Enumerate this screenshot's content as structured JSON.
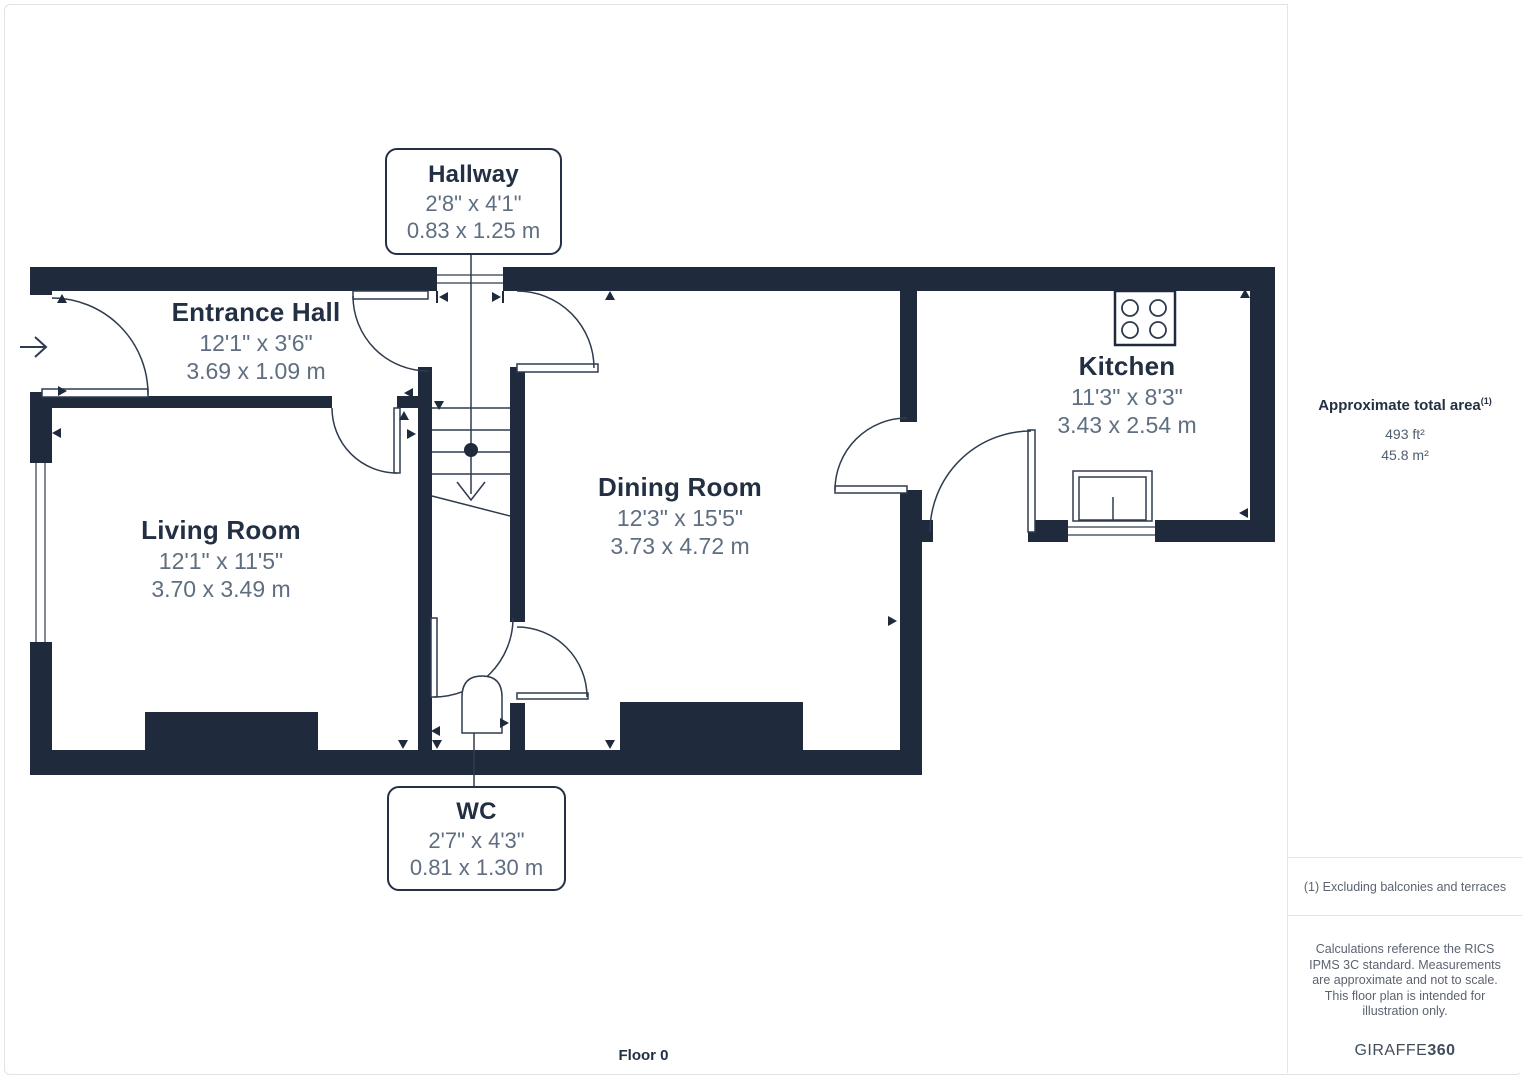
{
  "floor_plan": {
    "floor_label": "Floor 0",
    "rooms": [
      {
        "name": "Hallway",
        "imperial": "2'8\" x 4'1\"",
        "metric": "0.83 x 1.25 m"
      },
      {
        "name": "Entrance Hall",
        "imperial": "12'1\" x 3'6\"",
        "metric": "3.69 x 1.09 m"
      },
      {
        "name": "Living Room",
        "imperial": "12'1\" x 11'5\"",
        "metric": "3.70 x 3.49 m"
      },
      {
        "name": "Dining Room",
        "imperial": "12'3\" x 15'5\"",
        "metric": "3.73 x 4.72 m"
      },
      {
        "name": "Kitchen",
        "imperial": "11'3\" x 8'3\"",
        "metric": "3.43 x 2.54 m"
      },
      {
        "name": "WC",
        "imperial": "2'7\" x 4'3\"",
        "metric": "0.81 x 1.30 m"
      }
    ]
  },
  "sidebar": {
    "total_area_title": "Approximate total area",
    "total_area_superscript": "(1)",
    "area_ft": "493 ft²",
    "area_m": "45.8 m²",
    "footnote": "(1) Excluding balconies and terraces",
    "disclaimer": "Calculations reference the RICS IPMS 3C standard. Measurements are approximate and not to scale. This floor plan is intended for illustration only.",
    "brand_name": "GIRAFFE",
    "brand_suffix": "360"
  },
  "colors": {
    "wall": "#1f2b3c",
    "room_title_text": "#233043",
    "dimension_text": "#5f6e80",
    "fine_print_text": "#5c6370",
    "divider": "#e3e3e3"
  }
}
